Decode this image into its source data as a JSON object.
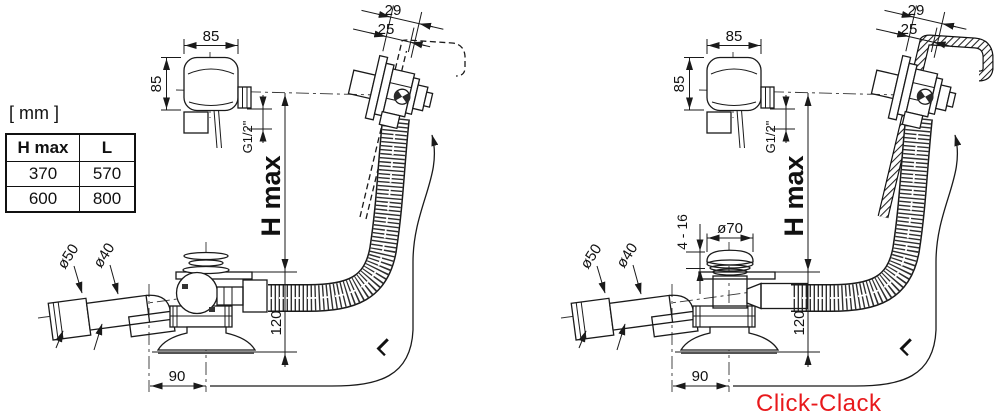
{
  "units_label": "[ mm ]",
  "table": {
    "headers": [
      "H max",
      "L"
    ],
    "rows": [
      [
        "370",
        "570"
      ],
      [
        "600",
        "800"
      ]
    ]
  },
  "caption": {
    "click_clack": "Click-Clack"
  },
  "colors": {
    "line": "#1a1a1a",
    "accent_red": "#e8191c"
  },
  "diagram_left": {
    "dim_width": "85",
    "dim_height": "85",
    "dim_29": "29",
    "dim_25": "25",
    "thread_size": "G1/2\"",
    "h_max": "H max",
    "dia_50": "ø50",
    "dia_40": "ø40",
    "dim_120": "120",
    "dim_90": "90",
    "length": "L"
  },
  "diagram_right": {
    "dim_width": "85",
    "dim_height": "85",
    "dim_29": "29",
    "dim_25": "25",
    "thread_size": "G1/2\"",
    "h_max": "H max",
    "dia_50": "ø50",
    "dia_40": "ø40",
    "dim_120": "120",
    "dim_90": "90",
    "length": "L",
    "dia_70": "ø70",
    "plug_range": "4 - 16"
  }
}
